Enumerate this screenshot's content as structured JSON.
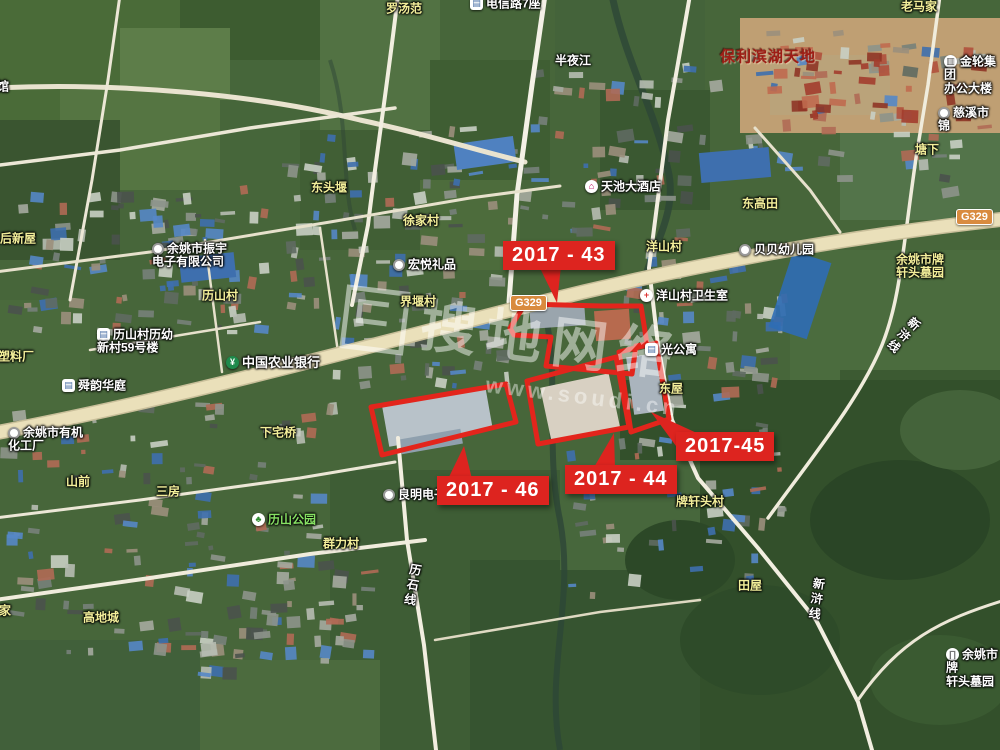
{
  "app": {
    "description": "卫星地图截图（土地出让地块示意）"
  },
  "watermark": {
    "brand": "搜地网络",
    "url": "www.soudi.cn"
  },
  "road_badges": [
    {
      "label": "G329"
    },
    {
      "label": "G329"
    }
  ],
  "parcels": [
    {
      "id": "2017-43",
      "label": "2017 - 43"
    },
    {
      "id": "2017-44",
      "label": "2017 - 44"
    },
    {
      "id": "2017-45",
      "label": "2017-45"
    },
    {
      "id": "2017-46",
      "label": "2017 - 46"
    }
  ],
  "icons": {
    "dot": "●",
    "cross": "+",
    "bank": "¥",
    "tree": "♣",
    "building": "▤",
    "hotel": "⌂",
    "gate": "∏",
    "circle_building": "▥"
  },
  "places": [
    {
      "text": "馆"
    },
    {
      "text": "罗汤范"
    },
    {
      "text": "电信路7座"
    },
    {
      "text": "半夜江"
    },
    {
      "text": "保利滨湖天地"
    },
    {
      "text": "老马家"
    },
    {
      "text": "金轮集团\n办公大楼"
    },
    {
      "text": "慈溪市锦"
    },
    {
      "text": "塘下"
    },
    {
      "text": "东头堰"
    },
    {
      "text": "天池大酒店"
    },
    {
      "text": "东高田"
    },
    {
      "text": "徐家村"
    },
    {
      "text": "洋山村"
    },
    {
      "text": "贝贝幼儿园"
    },
    {
      "text": "余姚市振宇\n电子有限公司"
    },
    {
      "text": "宏悦礼品"
    },
    {
      "text": "历山村"
    },
    {
      "text": "界堰村"
    },
    {
      "text": "洋山村卫生室"
    },
    {
      "text": "历山村历幼\n新村59号楼"
    },
    {
      "text": "塑料厂"
    },
    {
      "text": "中国农业银行"
    },
    {
      "text": "光公寓"
    },
    {
      "text": "舜韵华庭"
    },
    {
      "text": "东屋"
    },
    {
      "text": "余姚市有机\n化工厂"
    },
    {
      "text": "下宅桥"
    },
    {
      "text": "后新屋"
    },
    {
      "text": "山前"
    },
    {
      "text": "三房"
    },
    {
      "text": "良明电子"
    },
    {
      "text": "历山公园"
    },
    {
      "text": "群力村"
    },
    {
      "text": "牌轩头村"
    },
    {
      "text": "历石线"
    },
    {
      "text": "田屋"
    },
    {
      "text": "新浒线"
    },
    {
      "text": "新浒线"
    },
    {
      "text": "高地城"
    },
    {
      "text": "轩家"
    },
    {
      "text": "余姚市牌\n轩头墓园"
    },
    {
      "text": "柴里"
    }
  ]
}
